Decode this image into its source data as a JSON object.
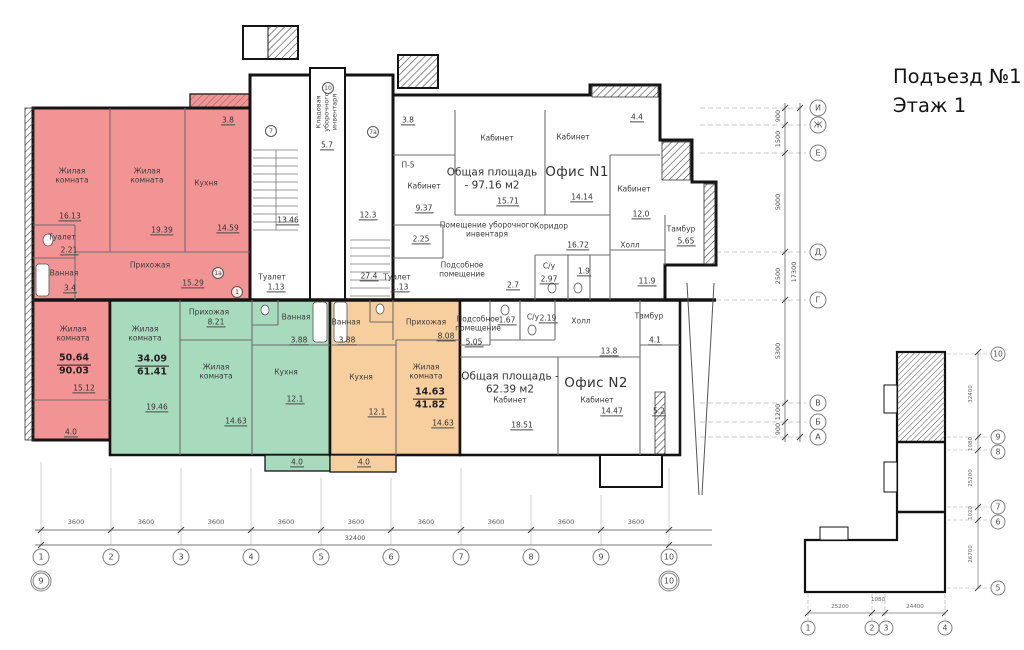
{
  "title": {
    "entrance": "Подъезд №1",
    "floor": "Этаж 1"
  },
  "labels": {
    "living_room": "Жилая комната",
    "kitchen": "Кухня",
    "hallway": "Прихожая",
    "toilet": "Туалет",
    "bathroom": "Ванная",
    "cabinet": "Кабинет",
    "corridor": "Коридор",
    "hall": "Холл",
    "tambour": "Тамбур",
    "wc": "С/у",
    "utility_room": "Подсобное помещение",
    "cleaning_storage": "Кладовая уборочного инвентаря",
    "cleaning_room": "Помещение уборочного инвентаря",
    "office1": "Офис N1",
    "office2": "Офис N2",
    "office1_total": "Общая площадь - 97.16 м2",
    "office2_total": "Общая площадь - 62.39 м2"
  },
  "apt_red": {
    "living1_area": "16.13",
    "living2_area": "19.39",
    "kitchen_area": "14.59",
    "toilet_area": "2.21",
    "bath_area": "3.4",
    "hallway_area": "15.29",
    "living3_area": "15.12",
    "living_total": "50.64",
    "total": "90.03",
    "balcony_top": "3.8",
    "balcony_bottom": "4.0"
  },
  "apt_green": {
    "living1_area": "19.46",
    "living2_area": "14.63",
    "kitchen_area": "12.1",
    "hallway_area": "8.21",
    "bath_area": "3.88",
    "toilet_area": "1.13",
    "living_total": "34.09",
    "total": "61.41",
    "balcony": "4.0",
    "dim": "27.4"
  },
  "apt_orange": {
    "living_area": "14.63",
    "kitchen_area": "12.1",
    "hallway_area": "8.08",
    "bath_area": "3.88",
    "toilet_area": "1.13",
    "living_total": "14.63",
    "total": "41.82",
    "balcony": "4.0"
  },
  "office1": {
    "cab_a": "9.37",
    "cab_b": "15.71",
    "cab_c": "14.14",
    "cab_d": "12.0",
    "cleaning": "2.25",
    "corridor": "16.72",
    "hall": "11.9",
    "wc_a": "2.97",
    "wc_b": "1.9",
    "small": "2.7",
    "tambour": "5.65",
    "balcony": "3.8",
    "dim": "4.4",
    "mark": "П-5"
  },
  "office2": {
    "utility": "5.05",
    "wc_a": "1.67",
    "wc_b": "2.19",
    "hall": "13.8",
    "tambour": "4.1",
    "cab_a": "18.51",
    "cab_b": "14.47",
    "ramp": "5.2"
  },
  "stairs": {
    "stair1": "13.46",
    "stair2": "12.3",
    "storage": "5.7"
  },
  "marks": {
    "m10": "10",
    "m7": "7",
    "m7a": "7а",
    "m1": "1",
    "m1a": "1а"
  },
  "grid_bottom": {
    "dims": [
      "3600",
      "3600",
      "3600",
      "3600",
      "3600",
      "3600",
      "3600",
      "3600",
      "3600"
    ],
    "total": "32400",
    "axes": [
      "1",
      "2",
      "3",
      "4",
      "5",
      "6",
      "7",
      "8",
      "9",
      "10"
    ],
    "axis_extra_left": "9",
    "axis_extra_right": "10"
  },
  "grid_right": {
    "dims": [
      "900",
      "1500",
      "5000",
      "2500",
      "5300",
      "1200",
      "900"
    ],
    "total": "17300",
    "axes": [
      "И",
      "Ж",
      "Е",
      "Д",
      "Г",
      "В",
      "Б",
      "А"
    ]
  },
  "keyplan": {
    "axes_right": [
      "10",
      "9",
      "8",
      "7",
      "6",
      "5"
    ],
    "axes_bottom": [
      "1",
      "2",
      "3",
      "4"
    ],
    "dims_right": [
      "32400",
      "1080",
      "25200",
      "1020",
      "26700"
    ],
    "dims_bottom": [
      "25200",
      "1080",
      "24400"
    ]
  },
  "colors": {
    "apartment_red": "#F29493",
    "apartment_green": "#A8DBBE",
    "apartment_orange": "#F7CE9D",
    "walls": "#141414"
  }
}
